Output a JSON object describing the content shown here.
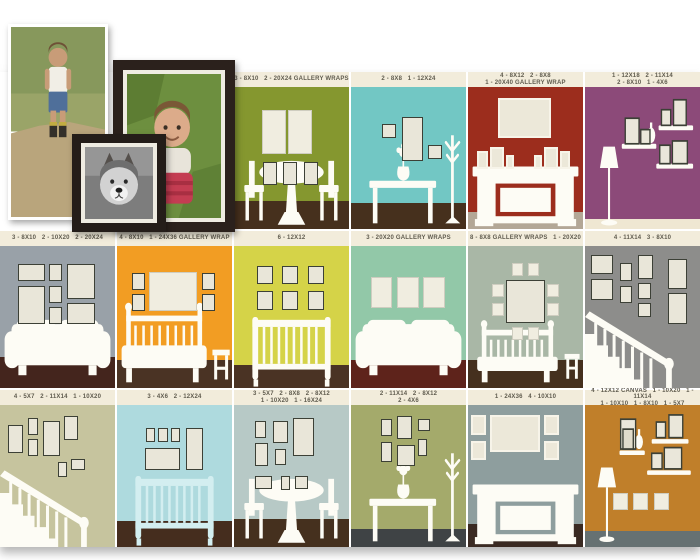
{
  "page": {
    "background": "#ffffff",
    "caption_bar_color": "#f2ecdb",
    "caption_text_color": "#5f5b4e",
    "frame_fill": "#e9e6d9",
    "frame_border": "#3c4036",
    "furniture_color": "#fdfcf5"
  },
  "photo_collage": {
    "items": [
      {
        "name": "boy-photo",
        "style": "white-border print"
      },
      {
        "name": "baby-photo-framed",
        "style": "dark wood frame"
      },
      {
        "name": "dog-photo-framed",
        "style": "dark wood frame, black and white"
      }
    ]
  },
  "panels": [
    {
      "id": "dining-olive",
      "caption": "3 - 8X10   2 - 20X24 GALLERY WRAPS",
      "wall": "#85972f",
      "floor": {
        "color": "#46301d",
        "h": 20
      },
      "scene": "table",
      "frames": [
        {
          "x": 24,
          "y": 16,
          "w": 21,
          "h": 31,
          "s": "wrap"
        },
        {
          "x": 47,
          "y": 16,
          "w": 21,
          "h": 31,
          "s": "wrap"
        },
        {
          "x": 25,
          "y": 53,
          "w": 12,
          "h": 16
        },
        {
          "x": 43,
          "y": 53,
          "w": 12,
          "h": 16
        },
        {
          "x": 61,
          "y": 53,
          "w": 12,
          "h": 16
        }
      ]
    },
    {
      "id": "console-teal",
      "caption": "2 - 8X8   1 - 12X24",
      "wall": "#72c7c4",
      "floor": {
        "color": "#46301d",
        "h": 18
      },
      "scene": "console",
      "frames": [
        {
          "x": 27,
          "y": 26,
          "w": 12,
          "h": 10
        },
        {
          "x": 44,
          "y": 21,
          "w": 19,
          "h": 31
        },
        {
          "x": 67,
          "y": 41,
          "w": 12,
          "h": 10
        }
      ]
    },
    {
      "id": "fireplace-red",
      "caption": "4 - 8X12   2 - 8X8\n1 - 20X40 GALLERY WRAP",
      "wall": "#9c2d1d",
      "floor": {
        "color": "#b3a796",
        "h": 12
      },
      "scene": "fireplace",
      "frames": [
        {
          "x": 26,
          "y": 8,
          "w": 46,
          "h": 28,
          "s": "white"
        },
        {
          "x": 8,
          "y": 45,
          "w": 9,
          "h": 13,
          "s": "white"
        },
        {
          "x": 19,
          "y": 42,
          "w": 12,
          "h": 16,
          "s": "white"
        },
        {
          "x": 33,
          "y": 48,
          "w": 7,
          "h": 10,
          "s": "white"
        },
        {
          "x": 57,
          "y": 48,
          "w": 7,
          "h": 10,
          "s": "white"
        },
        {
          "x": 66,
          "y": 42,
          "w": 12,
          "h": 16,
          "s": "white"
        },
        {
          "x": 80,
          "y": 45,
          "w": 9,
          "h": 13,
          "s": "white"
        }
      ]
    },
    {
      "id": "shelves-purple",
      "caption": "1 - 12X18   2 - 11X14\n2 - 8X10   1 - 4X6",
      "wall": "#8c4a79",
      "floor": {
        "color": "#efe7d2",
        "h": 7
      },
      "scene": "shelvesP",
      "frames": []
    },
    {
      "id": "sofa-gray",
      "caption": "3 - 8X10   2 - 10X20   2 - 20X24",
      "wall": "#99a1a8",
      "floor": {
        "color": "#44251d",
        "h": 22
      },
      "scene": "sofa",
      "frames": [
        {
          "x": 16,
          "y": 13,
          "w": 23,
          "h": 12
        },
        {
          "x": 16,
          "y": 28,
          "w": 23,
          "h": 27
        },
        {
          "x": 43,
          "y": 13,
          "w": 11,
          "h": 12
        },
        {
          "x": 43,
          "y": 28,
          "w": 11,
          "h": 12
        },
        {
          "x": 43,
          "y": 43,
          "w": 11,
          "h": 12
        },
        {
          "x": 58,
          "y": 13,
          "w": 25,
          "h": 24
        },
        {
          "x": 58,
          "y": 40,
          "w": 25,
          "h": 15
        }
      ]
    },
    {
      "id": "bed-orange",
      "caption": "4 - 8X10   1 - 24X36 GALLERY WRAP",
      "wall": "#f29d23",
      "floor": {
        "color": "#4a3324",
        "h": 20
      },
      "scene": "bed",
      "frames": [
        {
          "x": 13,
          "y": 19,
          "w": 11,
          "h": 12
        },
        {
          "x": 13,
          "y": 34,
          "w": 11,
          "h": 12
        },
        {
          "x": 28,
          "y": 18,
          "w": 42,
          "h": 28,
          "s": "wrap"
        },
        {
          "x": 74,
          "y": 19,
          "w": 11,
          "h": 12
        },
        {
          "x": 74,
          "y": 34,
          "w": 11,
          "h": 12
        }
      ]
    },
    {
      "id": "crib-chartreuse",
      "caption": "6 - 12X12",
      "wall": "#d5d348",
      "floor": {
        "color": "#4a3324",
        "h": 16
      },
      "scene": "crib",
      "frames": [
        {
          "x": 20,
          "y": 14,
          "w": 14,
          "h": 13
        },
        {
          "x": 42,
          "y": 14,
          "w": 14,
          "h": 13
        },
        {
          "x": 64,
          "y": 14,
          "w": 14,
          "h": 13
        },
        {
          "x": 20,
          "y": 32,
          "w": 14,
          "h": 13
        },
        {
          "x": 42,
          "y": 32,
          "w": 14,
          "h": 13
        },
        {
          "x": 64,
          "y": 32,
          "w": 14,
          "h": 13
        }
      ]
    },
    {
      "id": "sofa-seafoam",
      "caption": "3 - 20X20 GALLERY WRAPS",
      "wall": "#92c8a8",
      "floor": {
        "color": "#5e231b",
        "h": 20
      },
      "scene": "sofa",
      "frames": [
        {
          "x": 17,
          "y": 22,
          "w": 19,
          "h": 22,
          "s": "wrap"
        },
        {
          "x": 40,
          "y": 22,
          "w": 19,
          "h": 22,
          "s": "wrap"
        },
        {
          "x": 63,
          "y": 22,
          "w": 19,
          "h": 22,
          "s": "wrap"
        }
      ]
    },
    {
      "id": "bench-sage",
      "caption": "8 - 8X8 GALLERY WRAPS   1 - 20X20",
      "wall": "#a9b7a6",
      "floor": {
        "color": "#45301e",
        "h": 20
      },
      "scene": "bench",
      "frames": [
        {
          "x": 33,
          "y": 24,
          "w": 34,
          "h": 30
        },
        {
          "x": 38,
          "y": 12,
          "w": 10,
          "h": 9,
          "s": "wrap"
        },
        {
          "x": 52,
          "y": 12,
          "w": 10,
          "h": 9,
          "s": "wrap"
        },
        {
          "x": 21,
          "y": 27,
          "w": 10,
          "h": 9,
          "s": "wrap"
        },
        {
          "x": 21,
          "y": 40,
          "w": 10,
          "h": 9,
          "s": "wrap"
        },
        {
          "x": 69,
          "y": 27,
          "w": 10,
          "h": 9,
          "s": "wrap"
        },
        {
          "x": 69,
          "y": 40,
          "w": 10,
          "h": 9,
          "s": "wrap"
        },
        {
          "x": 38,
          "y": 57,
          "w": 10,
          "h": 9,
          "s": "wrap"
        },
        {
          "x": 52,
          "y": 57,
          "w": 10,
          "h": 9,
          "s": "wrap"
        }
      ]
    },
    {
      "id": "stairs-gray",
      "caption": "4 - 11X14   3 - 8X10",
      "wall": "#8d8d8b",
      "floor": null,
      "scene": "stairs",
      "frames": [
        {
          "x": 5,
          "y": 6,
          "w": 19,
          "h": 14
        },
        {
          "x": 5,
          "y": 23,
          "w": 19,
          "h": 15
        },
        {
          "x": 30,
          "y": 12,
          "w": 11,
          "h": 13
        },
        {
          "x": 30,
          "y": 28,
          "w": 11,
          "h": 12
        },
        {
          "x": 46,
          "y": 6,
          "w": 13,
          "h": 17
        },
        {
          "x": 46,
          "y": 26,
          "w": 11,
          "h": 11
        },
        {
          "x": 46,
          "y": 40,
          "w": 11,
          "h": 10
        },
        {
          "x": 72,
          "y": 9,
          "w": 17,
          "h": 21
        },
        {
          "x": 72,
          "y": 33,
          "w": 17,
          "h": 22
        }
      ]
    },
    {
      "id": "stairs-khaki",
      "caption": "4 - 5X7   2 - 11X14   1 - 10X20",
      "wall": "#c6c49e",
      "floor": null,
      "scene": "stairs",
      "frames": [
        {
          "x": 7,
          "y": 14,
          "w": 13,
          "h": 20
        },
        {
          "x": 24,
          "y": 9,
          "w": 9,
          "h": 12
        },
        {
          "x": 24,
          "y": 24,
          "w": 9,
          "h": 12
        },
        {
          "x": 37,
          "y": 11,
          "w": 15,
          "h": 25
        },
        {
          "x": 56,
          "y": 8,
          "w": 12,
          "h": 17
        },
        {
          "x": 50,
          "y": 40,
          "w": 8,
          "h": 11
        },
        {
          "x": 62,
          "y": 38,
          "w": 12,
          "h": 8
        }
      ]
    },
    {
      "id": "crib-blue",
      "caption": "3 - 4X6   2 - 12X24",
      "wall": "#aedade",
      "floor": {
        "color": "#452d1e",
        "h": 18
      },
      "scene": "cribBlue",
      "frames": [
        {
          "x": 25,
          "y": 16,
          "w": 8,
          "h": 10
        },
        {
          "x": 36,
          "y": 16,
          "w": 8,
          "h": 10
        },
        {
          "x": 47,
          "y": 16,
          "w": 8,
          "h": 10
        },
        {
          "x": 24,
          "y": 30,
          "w": 31,
          "h": 16
        },
        {
          "x": 60,
          "y": 16,
          "w": 15,
          "h": 30
        }
      ]
    },
    {
      "id": "dining-bluegray",
      "caption": "3 - 5X7   2 - 8X8   2 - 8X12\n1 - 10X20   1 - 16X24",
      "wall": "#b7c9c6",
      "floor": {
        "color": "#45301e",
        "h": 20
      },
      "scene": "table",
      "frames": [
        {
          "x": 18,
          "y": 11,
          "w": 10,
          "h": 12
        },
        {
          "x": 18,
          "y": 27,
          "w": 12,
          "h": 16
        },
        {
          "x": 34,
          "y": 11,
          "w": 13,
          "h": 16
        },
        {
          "x": 36,
          "y": 31,
          "w": 9,
          "h": 11
        },
        {
          "x": 51,
          "y": 9,
          "w": 19,
          "h": 27
        },
        {
          "x": 18,
          "y": 50,
          "w": 15,
          "h": 9
        },
        {
          "x": 41,
          "y": 50,
          "w": 8,
          "h": 10
        },
        {
          "x": 53,
          "y": 50,
          "w": 11,
          "h": 9
        }
      ]
    },
    {
      "id": "console-olive",
      "caption": "2 - 11X14   2 - 8X12\n2 - 4X6",
      "wall": "#a4aa6b",
      "floor": {
        "color": "#3f4345",
        "h": 13
      },
      "scene": "console",
      "frames": [
        {
          "x": 26,
          "y": 10,
          "w": 10,
          "h": 12
        },
        {
          "x": 40,
          "y": 8,
          "w": 13,
          "h": 16
        },
        {
          "x": 58,
          "y": 10,
          "w": 11,
          "h": 8
        },
        {
          "x": 26,
          "y": 26,
          "w": 10,
          "h": 14
        },
        {
          "x": 40,
          "y": 28,
          "w": 16,
          "h": 15
        },
        {
          "x": 58,
          "y": 24,
          "w": 8,
          "h": 12
        }
      ]
    },
    {
      "id": "fireplace-slate",
      "caption": "1 - 24X36   4 - 10X10",
      "wall": "#8e9e9e",
      "floor": {
        "color": "#3a2a22",
        "h": 16
      },
      "scene": "fireplace",
      "frames": [
        {
          "x": 3,
          "y": 7,
          "w": 13,
          "h": 14,
          "s": "white"
        },
        {
          "x": 3,
          "y": 25,
          "w": 13,
          "h": 14,
          "s": "white"
        },
        {
          "x": 19,
          "y": 7,
          "w": 44,
          "h": 26,
          "s": "white"
        },
        {
          "x": 66,
          "y": 7,
          "w": 13,
          "h": 14,
          "s": "white"
        },
        {
          "x": 66,
          "y": 25,
          "w": 13,
          "h": 14,
          "s": "white"
        }
      ]
    },
    {
      "id": "shelves-amber",
      "caption": "4 - 12X12 CANVAS   1 - 10X20   1 - 11X14\n1 - 10X10   1 - 8X10   1 - 5X7",
      "wall": "#c07f2a",
      "floor": {
        "color": "#667172",
        "h": 11
      },
      "scene": "shelvesA",
      "frames": [
        {
          "x": 24,
          "y": 62,
          "w": 13,
          "h": 12,
          "s": "wrap"
        },
        {
          "x": 42,
          "y": 62,
          "w": 13,
          "h": 12,
          "s": "wrap"
        },
        {
          "x": 60,
          "y": 62,
          "w": 13,
          "h": 12,
          "s": "wrap"
        }
      ]
    }
  ]
}
